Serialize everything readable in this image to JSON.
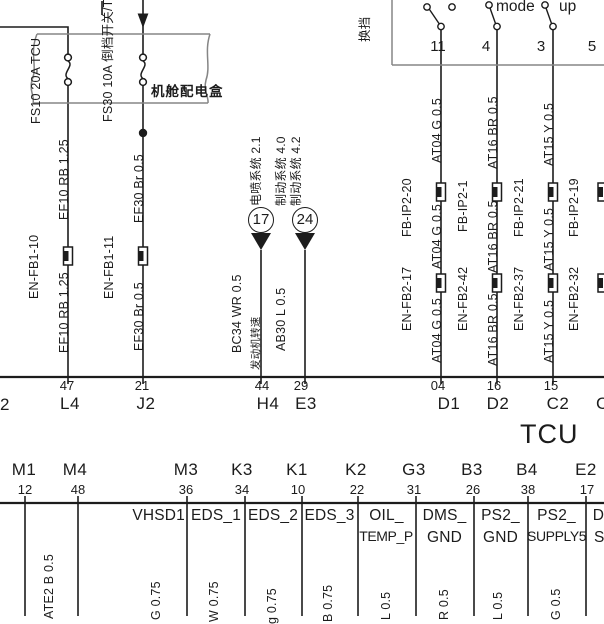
{
  "colors": {
    "ink": "#1c1c1c",
    "box_outline": "#858585",
    "background": "#ffffff"
  },
  "diagram": {
    "power_box": {
      "name": "机舱配电盒",
      "fuse1_label": "FS10 20A TCU",
      "fuse2_label": "FS30 10A 倒档开关/TCU"
    },
    "shift_panel": {
      "edge_label": "换挡",
      "mode_label": "mode",
      "up_label": "up",
      "pins": [
        "11",
        "4",
        "3",
        "5"
      ]
    },
    "left_wires": {
      "w1_top": "EF10 RB 1.25",
      "w1_splice": "EN-FB1-10",
      "w1_bot": "EF10 RB 1.25",
      "w2_top": "EF30 Br 0.5",
      "w2_splice": "EN-FB1-11",
      "w2_bot": "EF30 Br 0.5"
    },
    "offpage_17": {
      "num": "17",
      "sys": "电喷系统 2.1",
      "wire": "BC34 WR 0.5",
      "signal": "发动机转速"
    },
    "offpage_24": {
      "num": "24",
      "sys_a": "制动系统 4.0",
      "sys_b": "制动系统 4.2",
      "wire": "AB30 L 0.5"
    },
    "right_wires": {
      "w1_top": "AT04 G 0.5",
      "w1_s1": "FB-IP2-20",
      "w1_mid": "AT04 G 0.5",
      "w1_s2": "EN-FB2-17",
      "w1_bot": "AT04 G 0.5",
      "w2_top": "AT16 BR 0.5",
      "w2_s1": "FB-IP2-1",
      "w2_mid": "AT16 BR 0.5",
      "w2_s2": "EN-FB2-42",
      "w2_bot": "AT16 BR 0.5",
      "w3_top": "AT15 Y 0.5",
      "w3_s1": "FB-IP2-21",
      "w3_mid": "AT15 Y 0.5",
      "w3_s2": "EN-FB2-37",
      "w3_bot": "AT15 Y 0.5",
      "w4_s1": "FB-IP2-19",
      "w4_s2": "EN-FB2-32"
    },
    "tcu": {
      "name": "TCU",
      "row_top": [
        {
          "pin": "47",
          "name": "L4"
        },
        {
          "pin": "21",
          "name": "J2"
        },
        {
          "pin": "44",
          "name": "H4"
        },
        {
          "pin": "29",
          "name": "E3"
        },
        {
          "pin": "04",
          "name": "D1"
        },
        {
          "pin": "16",
          "name": "D2"
        },
        {
          "pin": "15",
          "name": "C2"
        }
      ],
      "row_top_partial_left": "2",
      "row_top_partial_right": "C",
      "row_bottom": [
        {
          "name": "M1",
          "pin": "12"
        },
        {
          "name": "M4",
          "pin": "48"
        },
        {
          "name": "M3",
          "pin": "36"
        },
        {
          "name": "K3",
          "pin": "34"
        },
        {
          "name": "K1",
          "pin": "10"
        },
        {
          "name": "K2",
          "pin": "22"
        },
        {
          "name": "G3",
          "pin": "31"
        },
        {
          "name": "B3",
          "pin": "26"
        },
        {
          "name": "B4",
          "pin": "38"
        },
        {
          "name": "E2",
          "pin": "17"
        }
      ],
      "signals": [
        {
          "l1": "VHSD1",
          "l2": ""
        },
        {
          "l1": "EDS_1",
          "l2": ""
        },
        {
          "l1": "EDS_2",
          "l2": ""
        },
        {
          "l1": "EDS_3",
          "l2": ""
        },
        {
          "l1": "OIL_",
          "l2": "TEMP_P"
        },
        {
          "l1": "DMS_",
          "l2": "GND"
        },
        {
          "l1": "PS2_",
          "l2": "GND"
        },
        {
          "l1": "PS2_",
          "l2": "SUPPLY5"
        },
        {
          "l1": "DM",
          "l2": "SU"
        }
      ]
    },
    "bottom_wire_labels": [
      "ATE1 B 1.25",
      "ATE2 B 0.5",
      "G 0.75",
      "W 0.75",
      "g 0.75",
      "B 0.75",
      "L 0.5",
      "R 0.5",
      "L 0.5",
      "G 0.5"
    ]
  }
}
